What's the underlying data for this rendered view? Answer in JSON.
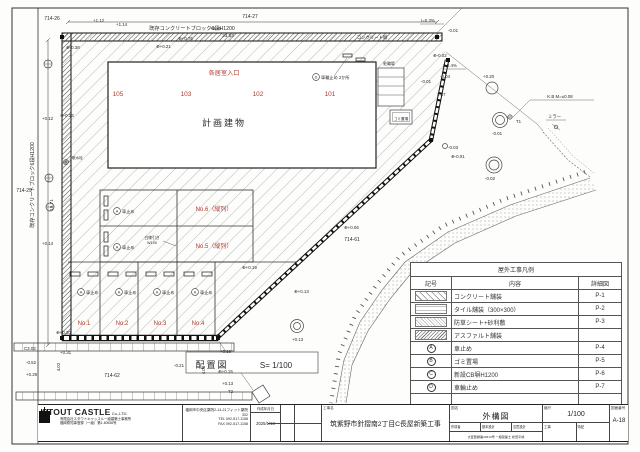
{
  "plan": {
    "title": "配置図",
    "scale_note": "S= 1/100",
    "building_label": "計画建物",
    "entrance_label": "各居室入口",
    "units": [
      "105",
      "103",
      "102",
      "101"
    ],
    "stalls": [
      "No.1",
      "No.2",
      "No.3",
      "No.4"
    ],
    "stall5": "No.5（縦列）",
    "stall6": "No.6（縦列）",
    "car_stop": "車止め",
    "sym_a": "A",
    "sym_d": "D",
    "wheel_stop_note": "車輪止め 2か所",
    "white_line1": "白線引き",
    "white_line2": "W100",
    "bike": "駐輪場",
    "trash": "ゴミ置場",
    "sprinkler": "散水栓",
    "wall_top": "既存コンクリートブロック6段H1200",
    "wall_left": "既存コンクリートブロック6段H1200",
    "conc_wall": "コンクリート塀",
    "spots": [
      "714-26",
      "714-27",
      "714-29",
      "714-62",
      "714-61",
      "23.53",
      "19.71",
      "4.02",
      "4.00",
      "+1.12",
      "+1.14",
      "⊕-0.38",
      "⊕+0.75",
      "+0.25",
      "⊕+0.21",
      "I=0.3%",
      "-0.01",
      "⊕-0.02",
      "-0.01",
      "2.67",
      "I=0.4%",
      "-0.04",
      "+0.20",
      "-0.01",
      "-0.02",
      "K.B M=±0.08",
      "T1",
      "ミラー",
      "-0.03",
      "⊕-0.01",
      "⊕+0.06",
      "⊕+0.19",
      "⊕+0.13",
      "+0.13",
      "+0.12",
      "⊕-0.13",
      "+0.14",
      "C3.03",
      "+0.31",
      "-0.52",
      "+0.29",
      "-0.21",
      "⊕+0.15",
      "+0.13",
      "T2",
      "+0.16",
      "⊕+0.30"
    ]
  },
  "legend": {
    "title": "屋外工事凡例",
    "headers": [
      "記号",
      "内容",
      "詳細図"
    ],
    "rows": [
      {
        "sym": "",
        "label": "コンクリート舗装",
        "detail": "P-1"
      },
      {
        "sym": "",
        "label": "タイル舗装（300×300）",
        "detail": "P-2"
      },
      {
        "sym": "",
        "label": "防草シート+砂利敷",
        "detail": "P-3"
      },
      {
        "sym": "",
        "label": "アスファルト舗装",
        "detail": ""
      },
      {
        "sym": "A",
        "label": "車止め",
        "detail": "P-4"
      },
      {
        "sym": "B",
        "label": "ゴミ置場",
        "detail": "P-5"
      },
      {
        "sym": "C",
        "label": "新設CB塀H1200",
        "detail": "P-6"
      },
      {
        "sym": "D",
        "label": "車輪止め",
        "detail": "P-7"
      },
      {
        "sym": "",
        "label": "",
        "detail": ""
      },
      {
        "sym": "",
        "label": "",
        "detail": ""
      }
    ]
  },
  "titleblock": {
    "company": "STOUT CASTLE",
    "company_suffix": "Co.,LTD.",
    "company_sub1": "有限会社スタウトキャッスル一級建築士事務所",
    "company_sub2": "福岡県知事登録（一級）第1-60536号",
    "address": "福岡市中央区薬院2-14-21フィット薬院302",
    "tel": "TEL 092-517-1158",
    "fax": "FAX 092-517-1158",
    "date_label": "作成年月日",
    "date": "2025/1/18",
    "project_label": "工事名",
    "project": "筑紫野市針摺南2丁目C長屋新築工事",
    "drawing_label": "図名",
    "drawing": "外構図",
    "scale_label": "縮尺",
    "scale": "1/100",
    "number_label": "図面番号",
    "number": "A-18",
    "staff": [
      "作成者",
      "基本設計",
      "意匠設計",
      "工事",
      "特記"
    ],
    "license": "大臣登録第20313号 一級建築士 松田平成"
  }
}
